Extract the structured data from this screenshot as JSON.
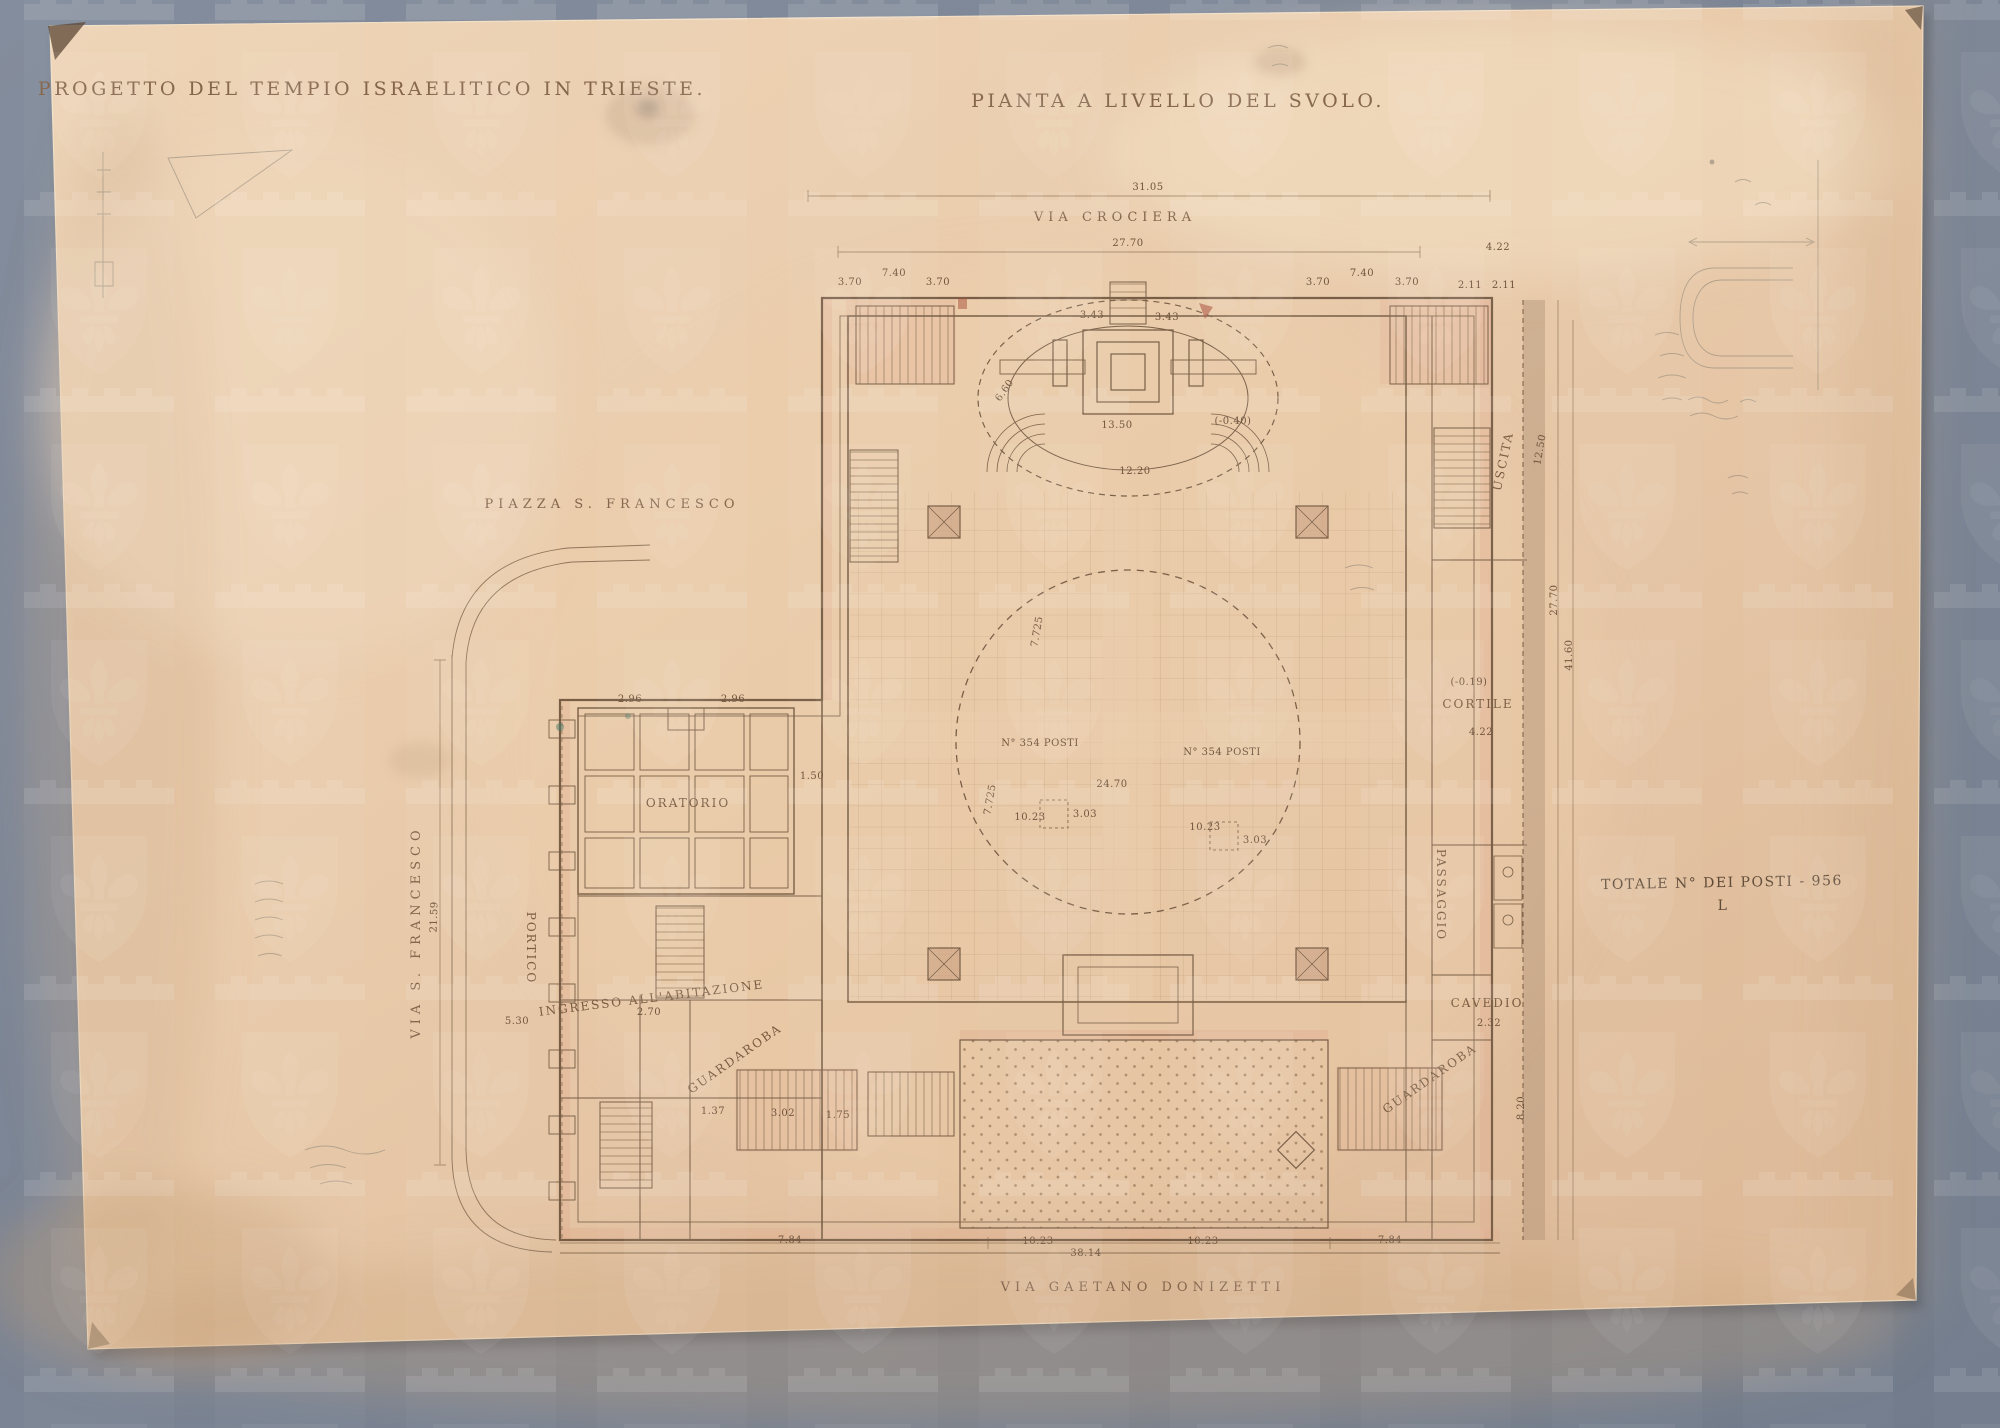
{
  "document": {
    "title_left": "PROGETTO DEL TEMPIO ISRAELITICO IN TRIESTE.",
    "title_right": "PIANTA A LIVELLO DEL SVOLO.",
    "seat_note": "TOTALE N° DEI POSTI - 956"
  },
  "colors": {
    "board": "#7d8696",
    "paper": "#e9cdad",
    "ink": "#6b523a",
    "pencil": "#8f8577",
    "wall_tint": "#e2a98e",
    "watermark": "#ffffff"
  },
  "annotations": {
    "titles": [
      {
        "text": "PROGETTO DEL TEMPIO ISRAELITICO IN TRIESTE.",
        "x": 372,
        "y": 95,
        "name": "title-left"
      },
      {
        "text": "PIANTA A LIVELLO DEL SVOLO.",
        "x": 1178,
        "y": 107,
        "name": "title-right"
      }
    ],
    "streets": [
      {
        "text": "VIA CROCIERA",
        "x": 1115,
        "y": 221,
        "name": "street-via-crociera"
      },
      {
        "text": "PIAZZA S. FRANCESCO",
        "x": 612,
        "y": 508,
        "name": "place-piazza-s-francesco"
      },
      {
        "text": "VIA S. FRANCESCO",
        "x": 420,
        "y": 932,
        "rotate": -90,
        "name": "street-via-s-francesco"
      },
      {
        "text": "VIA GAETANO DONIZETTI",
        "x": 1143,
        "y": 1291,
        "name": "street-via-gaetano-donizetti"
      }
    ],
    "rooms": [
      {
        "text": "ORATORIO",
        "x": 688,
        "y": 807,
        "size": 13,
        "spacing": 3,
        "name": "room-oratorio"
      },
      {
        "text": "PORTICO",
        "x": 527,
        "y": 948,
        "rotate": 90,
        "size": 11,
        "name": "room-portico"
      },
      {
        "text": "CORTILE",
        "x": 1478,
        "y": 708,
        "size": 11,
        "name": "room-cortile"
      },
      {
        "text": "PASSAGGIO",
        "x": 1437,
        "y": 895,
        "rotate": 90,
        "size": 8,
        "spacing": 1,
        "name": "room-passaggio"
      },
      {
        "text": "USCITA",
        "x": 1507,
        "y": 462,
        "rotate": -78,
        "size": 10,
        "name": "room-uscita"
      },
      {
        "text": "CAVEDIO",
        "x": 1487,
        "y": 1007,
        "size": 9,
        "spacing": 1,
        "name": "room-cavedio"
      },
      {
        "text": "GUARDAROBA",
        "x": 737,
        "y": 1062,
        "rotate": -35,
        "size": 9,
        "spacing": 1,
        "name": "room-guardaroba-left"
      },
      {
        "text": "GUARDAROBA",
        "x": 1432,
        "y": 1082,
        "rotate": -35,
        "size": 9,
        "spacing": 1,
        "name": "room-guardaroba-right"
      },
      {
        "text": "INGRESSO ALL'ABITAZIONE",
        "x": 652,
        "y": 1002,
        "rotate": -7,
        "size": 8.5,
        "spacing": 0.5,
        "name": "room-ingresso-abitazione"
      }
    ],
    "notes": [
      {
        "text": "TOTALE N° DEI POSTI - 956",
        "x": 1722,
        "y": 887,
        "rotate": -1,
        "name": "seat-total-note"
      },
      {
        "text": "L",
        "x": 1723,
        "y": 910,
        "size": 9,
        "name": "stray-mark"
      }
    ],
    "dims": [
      {
        "text": "31.05",
        "x": 1148,
        "y": 190
      },
      {
        "text": "27.70",
        "x": 1128,
        "y": 246
      },
      {
        "text": "3.70",
        "x": 1318,
        "y": 285
      },
      {
        "text": "7.40",
        "x": 1362,
        "y": 276
      },
      {
        "text": "3.70",
        "x": 1407,
        "y": 285
      },
      {
        "text": "4.22",
        "x": 1498,
        "y": 250
      },
      {
        "text": "2.11",
        "x": 1470,
        "y": 288
      },
      {
        "text": "2.11",
        "x": 1504,
        "y": 288
      },
      {
        "text": "3.70",
        "x": 938,
        "y": 285
      },
      {
        "text": "7.40",
        "x": 894,
        "y": 276
      },
      {
        "text": "3.70",
        "x": 850,
        "y": 285
      },
      {
        "text": "3.43",
        "x": 1092,
        "y": 318
      },
      {
        "text": "3.43",
        "x": 1167,
        "y": 320
      },
      {
        "text": "12.20",
        "x": 1135,
        "y": 474
      },
      {
        "text": "13.50",
        "x": 1117,
        "y": 428
      },
      {
        "text": "6.60",
        "x": 1007,
        "y": 392,
        "rotate": -55,
        "size": 8.5
      },
      {
        "text": "(-0.40)",
        "x": 1233,
        "y": 424,
        "size": 8.5
      },
      {
        "text": "N° 354 POSTI",
        "x": 1040,
        "y": 746,
        "size": 9.5
      },
      {
        "text": "N° 354 POSTI",
        "x": 1222,
        "y": 755,
        "size": 9.5
      },
      {
        "text": "24.70",
        "x": 1112,
        "y": 787
      },
      {
        "text": "10.23",
        "x": 1030,
        "y": 820
      },
      {
        "text": "10.23",
        "x": 1205,
        "y": 830
      },
      {
        "text": "7.725",
        "x": 993,
        "y": 800,
        "rotate": -80,
        "size": 8.5
      },
      {
        "text": "7.725",
        "x": 1040,
        "y": 632,
        "rotate": -80,
        "size": 8.5
      },
      {
        "text": "3.03",
        "x": 1085,
        "y": 817,
        "size": 8.5
      },
      {
        "text": "3.03",
        "x": 1255,
        "y": 843,
        "size": 8.5
      },
      {
        "text": "2.96",
        "x": 630,
        "y": 702,
        "size": 8.5
      },
      {
        "text": "2.96",
        "x": 733,
        "y": 702,
        "size": 8.5
      },
      {
        "text": "1.50",
        "x": 812,
        "y": 779,
        "size": 8.5
      },
      {
        "text": "5.30",
        "x": 517,
        "y": 1024,
        "size": 8.5
      },
      {
        "text": "21.59",
        "x": 437,
        "y": 917,
        "rotate": -88
      },
      {
        "text": "2.70",
        "x": 649,
        "y": 1015,
        "size": 8
      },
      {
        "text": "3.02",
        "x": 783,
        "y": 1116,
        "size": 8
      },
      {
        "text": "1.37",
        "x": 713,
        "y": 1114,
        "size": 8
      },
      {
        "text": "1.75",
        "x": 838,
        "y": 1118,
        "size": 8
      },
      {
        "text": "(-0.19)",
        "x": 1469,
        "y": 685,
        "size": 8.5
      },
      {
        "text": "4.22",
        "x": 1481,
        "y": 735
      },
      {
        "text": "12.50",
        "x": 1543,
        "y": 450,
        "rotate": -80
      },
      {
        "text": "2.32",
        "x": 1489,
        "y": 1026,
        "size": 8.5
      },
      {
        "text": "8.20",
        "x": 1524,
        "y": 1108,
        "rotate": -90
      },
      {
        "text": "27.70",
        "x": 1557,
        "y": 600,
        "rotate": -90
      },
      {
        "text": "41.60",
        "x": 1572,
        "y": 655,
        "rotate": -90
      },
      {
        "text": "7.84",
        "x": 790,
        "y": 1243
      },
      {
        "text": "10.23",
        "x": 1038,
        "y": 1244
      },
      {
        "text": "10.23",
        "x": 1203,
        "y": 1244
      },
      {
        "text": "38.14",
        "x": 1086,
        "y": 1256
      },
      {
        "text": "7.84",
        "x": 1390,
        "y": 1243
      }
    ]
  }
}
